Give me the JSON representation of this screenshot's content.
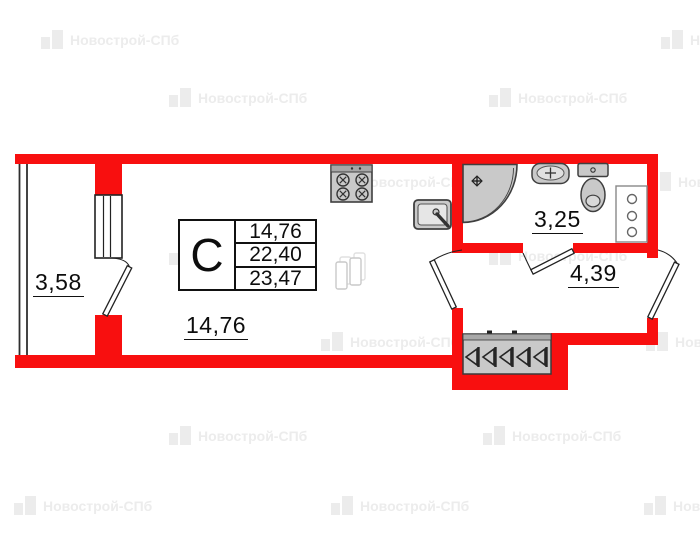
{
  "watermark": {
    "text": "Новострой-СПб"
  },
  "plan": {
    "type": "floor-plan",
    "unit": {
      "type_label": "С"
    },
    "info_table": {
      "type_label": "С",
      "rows": [
        "14,76",
        "22,40",
        "23,47"
      ]
    },
    "rooms": [
      {
        "name": "loggia",
        "area": "3,58"
      },
      {
        "name": "living-room",
        "area": "14,76"
      },
      {
        "name": "bathroom",
        "area": "3,25"
      },
      {
        "name": "hallway",
        "area": "4,39"
      }
    ],
    "fixtures": [
      "stove-icon",
      "kitchen-sink-icon",
      "fridge-icon",
      "shower-icon",
      "washbasin-icon",
      "toilet-icon",
      "utility-shaft-icon",
      "wardrobe-icon"
    ],
    "colors": {
      "wall": "#f80f0f",
      "fixture_fill": "#c9c9c9",
      "fixture_stroke": "#3f3f3f",
      "outline": "#1a1a1a",
      "watermark": "#ececec"
    }
  }
}
